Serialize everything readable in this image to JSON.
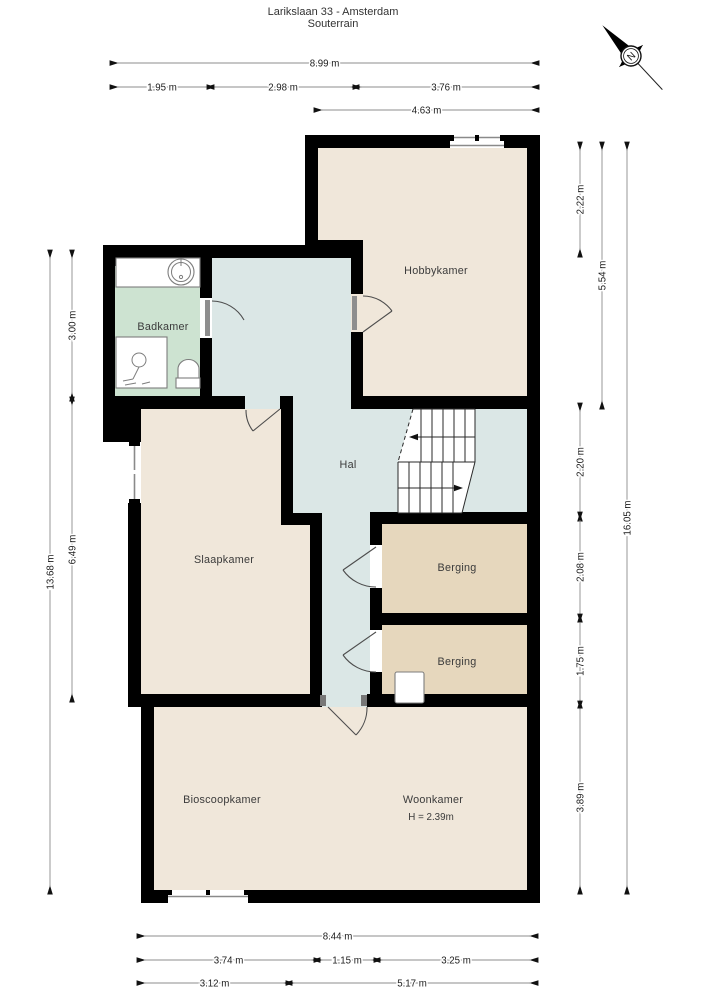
{
  "title": {
    "line1": "Larikslaan 33 - Amsterdam",
    "line2": "Souterrain"
  },
  "compass": {
    "label": "N"
  },
  "rooms": {
    "hobbykamer": {
      "label": "Hobbykamer"
    },
    "badkamer": {
      "label": "Badkamer"
    },
    "hal": {
      "label": "Hal"
    },
    "slaapkamer": {
      "label": "Slaapkamer"
    },
    "berging1": {
      "label": "Berging"
    },
    "berging2": {
      "label": "Berging"
    },
    "bioscoopkamer": {
      "label": "Bioscoopkamer"
    },
    "woonkamer": {
      "label": "Woonkamer",
      "height_note": "H = 2.39m"
    }
  },
  "dimensions": {
    "top": [
      {
        "label": "8.99 m"
      },
      {
        "label": "1.95 m"
      },
      {
        "label": "2.98 m"
      },
      {
        "label": "3.76 m"
      },
      {
        "label": "4.63 m"
      }
    ],
    "bottom": [
      {
        "label": "8.44 m"
      },
      {
        "label": "3.74 m"
      },
      {
        "label": "1.15 m"
      },
      {
        "label": "3.25 m"
      },
      {
        "label": "3.12 m"
      },
      {
        "label": "5.17 m"
      }
    ],
    "left": [
      {
        "label": "13.68 m"
      },
      {
        "label": "3.00 m"
      },
      {
        "label": "6.49 m"
      }
    ],
    "right": [
      {
        "label": "2.22 m"
      },
      {
        "label": "2.20 m"
      },
      {
        "label": "2.08 m"
      },
      {
        "label": "1.75 m"
      },
      {
        "label": "3.89 m"
      },
      {
        "label": "5.54 m"
      },
      {
        "label": "16.05 m"
      }
    ]
  },
  "colors": {
    "wall": "#000000",
    "room_beige": "#f0e7da",
    "hal_blue": "#dbe7e6",
    "badkamer_green": "#cde3d1",
    "berging_tan": "#e6d7bd",
    "dimension_line": "#8c8c8c",
    "arrowhead": "#111111",
    "text": "#3b3b3b"
  }
}
